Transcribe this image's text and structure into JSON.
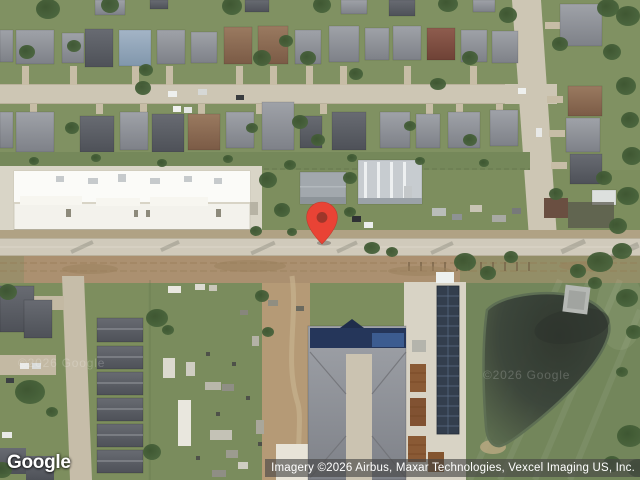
{
  "branding": {
    "logo_text": "Google"
  },
  "attribution": {
    "text": "Imagery ©2026 Airbus, Maxar Technologies, Vexcel Imaging US, Inc.",
    "background_color": "#474747",
    "text_color": "#ffffff"
  },
  "watermark": {
    "text": "©2026 Google"
  },
  "marker": {
    "color": "#E94335",
    "dot_color": "#9E362A"
  }
}
